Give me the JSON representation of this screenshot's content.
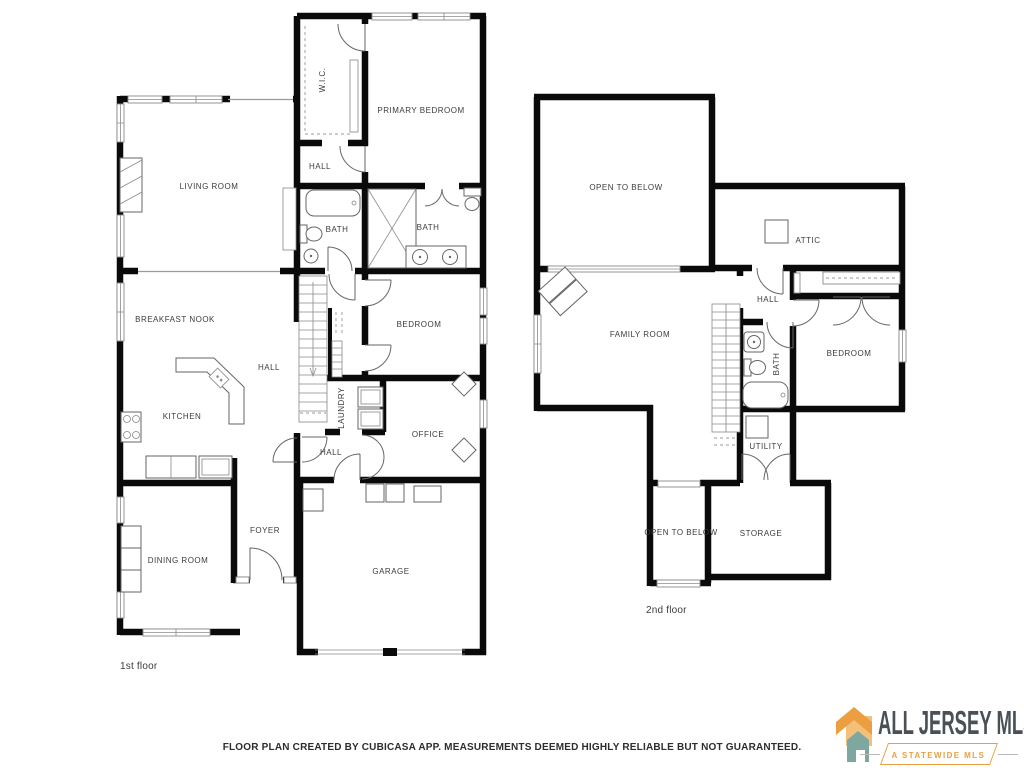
{
  "floors": {
    "first": {
      "label": "1st floor",
      "rooms": {
        "living_room": "LIVING ROOM",
        "wic": "W.I.C.",
        "primary_bedroom": "PRIMARY BEDROOM",
        "hall_top": "HALL",
        "bath_left": "BATH",
        "bath_right": "BATH",
        "breakfast_nook": "BREAKFAST NOOK",
        "hall_center": "HALL",
        "bedroom": "BEDROOM",
        "kitchen": "KITCHEN",
        "laundry": "LAUNDRY",
        "office": "OFFICE",
        "hall_lower": "HALL",
        "dining_room": "DINING ROOM",
        "foyer": "FOYER",
        "garage": "GARAGE"
      }
    },
    "second": {
      "label": "2nd floor",
      "rooms": {
        "open_to_below_top": "OPEN TO BELOW",
        "attic": "ATTIC",
        "hall": "HALL",
        "family_room": "FAMILY ROOM",
        "bath": "BATH",
        "bedroom": "BEDROOM",
        "utility": "UTILITY",
        "open_to_below_bottom": "OPEN TO BELOW",
        "storage": "STORAGE"
      }
    }
  },
  "footer": {
    "disclaimer": "FLOOR PLAN CREATED BY CUBICASA APP. MEASUREMENTS DEEMED HIGHLY RELIABLE BUT NOT GUARANTEED."
  },
  "logo": {
    "title": "ALL JERSEY MLS",
    "tagline": "A STATEWIDE MLS",
    "colors": {
      "orange": "#EC9F40",
      "light_orange": "#F3C07C",
      "teal": "#7EA7A0",
      "slate": "#4A5156"
    }
  }
}
